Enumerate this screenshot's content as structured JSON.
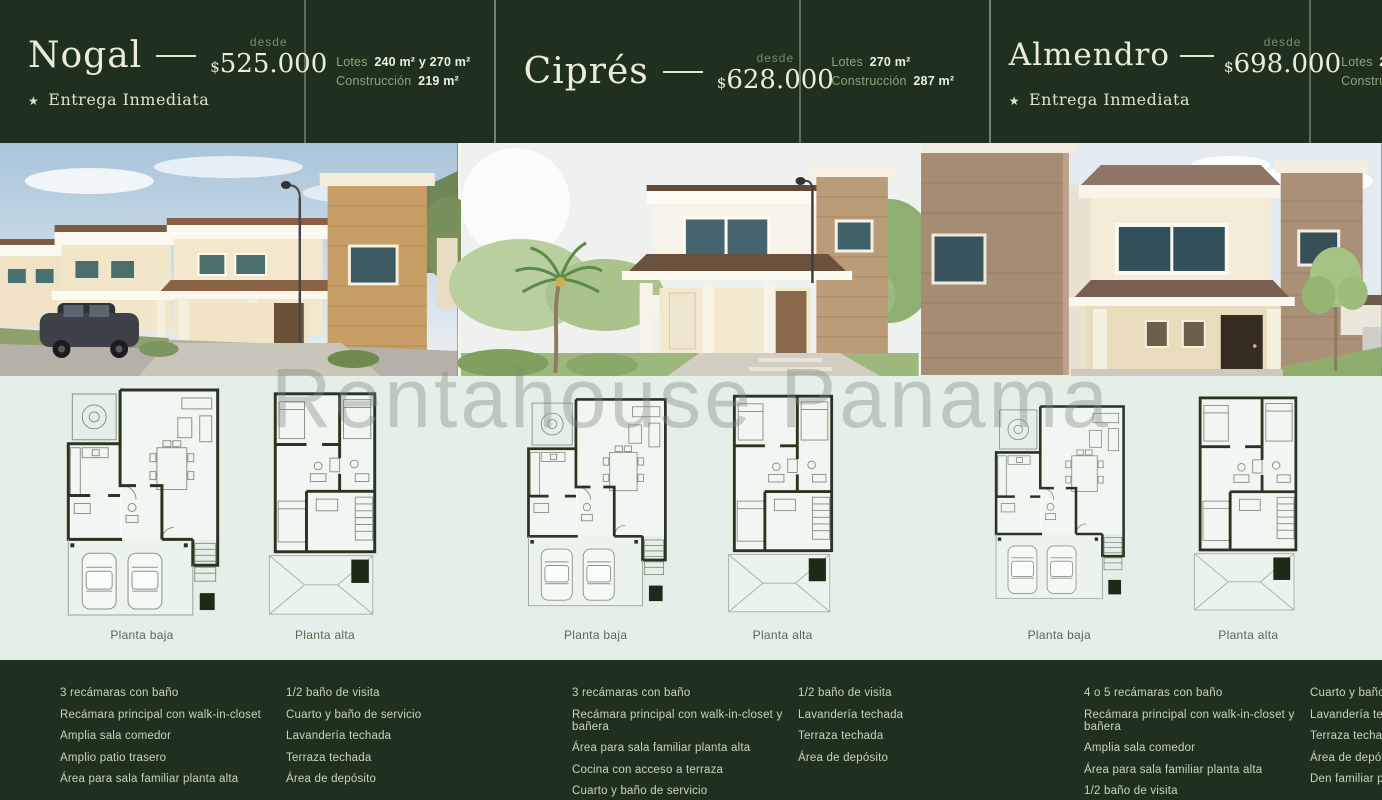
{
  "watermark": "Rentahouse Panama",
  "colors": {
    "dark_green": "#20301e",
    "light_green": "#e4efe7",
    "ivory": "#e9edda",
    "muted_olive": "#7f8d66"
  },
  "models": [
    {
      "name": "Nogal",
      "desde_label": "desde",
      "currency": "$",
      "price": "525.000",
      "star": "★",
      "badge": "Entrega Inmediata",
      "lots_label": "Lotes",
      "lots_value": "240 m² y 270 m²",
      "construction_label": "Construcción",
      "construction_value": "219 m²",
      "plans": [
        "Planta baja",
        "Planta alta"
      ],
      "features_col1": [
        "3 recámaras con baño",
        "Recámara principal con walk-in-closet",
        "Amplia sala comedor",
        "Amplio patio trasero",
        "Área para sala familiar planta alta"
      ],
      "features_col2": [
        "1/2 baño de visita",
        "Cuarto y baño de servicio",
        "Lavandería techada",
        "Terraza techada",
        "Área de depósito"
      ]
    },
    {
      "name": "Ciprés",
      "desde_label": "desde",
      "currency": "$",
      "price": "628.000",
      "lots_label": "Lotes",
      "lots_value": "270 m²",
      "construction_label": "Construcción",
      "construction_value": "287 m²",
      "plans": [
        "Planta baja",
        "Planta alta"
      ],
      "features_col1": [
        "3 recámaras con baño",
        "Recámara principal con walk-in-closet y bañera",
        "Área para sala familiar planta alta",
        "Cocina con acceso a terraza",
        "Cuarto y baño de servicio"
      ],
      "features_col2": [
        "1/2 baño de visita",
        "Lavandería techada",
        "Terraza techada",
        "Área de depósito"
      ]
    },
    {
      "name": "Almendro",
      "desde_label": "desde",
      "currency": "$",
      "price": "698.000",
      "star": "★",
      "badge": "Entrega Inmediata",
      "lots_label": "Lotes",
      "lots_value": "288 m² y 360 m²",
      "construction_label": "Construcción",
      "construction_value": "331 m²",
      "plans": [
        "Planta baja",
        "Planta alta"
      ],
      "features_col1": [
        "4 o 5 recámaras con baño",
        "Recámara principal con walk-in-closet y bañera",
        "Amplia sala comedor",
        "Área para sala familiar planta alta",
        "1/2 baño de visita"
      ],
      "features_col2": [
        "Cuarto y baño de servicio",
        "Lavandería techada",
        "Terraza techada",
        "Área de depósito",
        "Den familiar planta baja"
      ]
    }
  ]
}
